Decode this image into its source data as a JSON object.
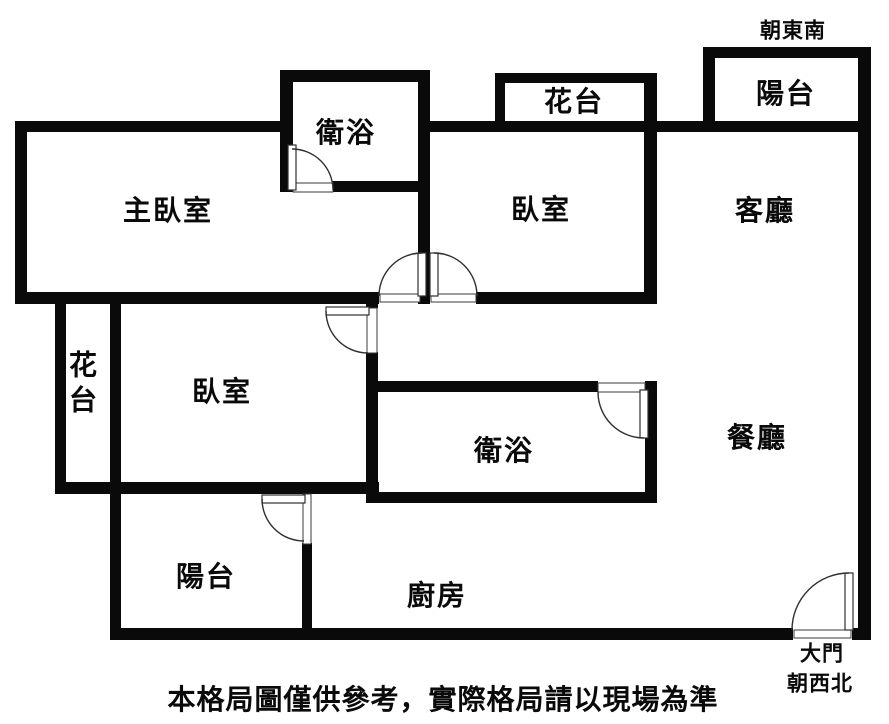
{
  "orientation": {
    "top": "朝東南",
    "bottom_door": "大門",
    "bottom_facing": "朝西北"
  },
  "rooms": {
    "balcony_top": "陽台",
    "flower_box_top": "花台",
    "bathroom_top": "衛浴",
    "master_bedroom": "主臥室",
    "bedroom_top": "臥室",
    "living_room": "客廳",
    "flower_box_left": [
      "花",
      "台"
    ],
    "bedroom_mid": "臥室",
    "bathroom_mid": "衛浴",
    "dining_room": "餐廳",
    "balcony_bottom": "陽台",
    "kitchen": "廚房"
  },
  "caption": "本格局圖僅供參考，實際格局請以現場為準",
  "colors": {
    "wall": "#0a0a0a",
    "background": "#ffffff"
  }
}
